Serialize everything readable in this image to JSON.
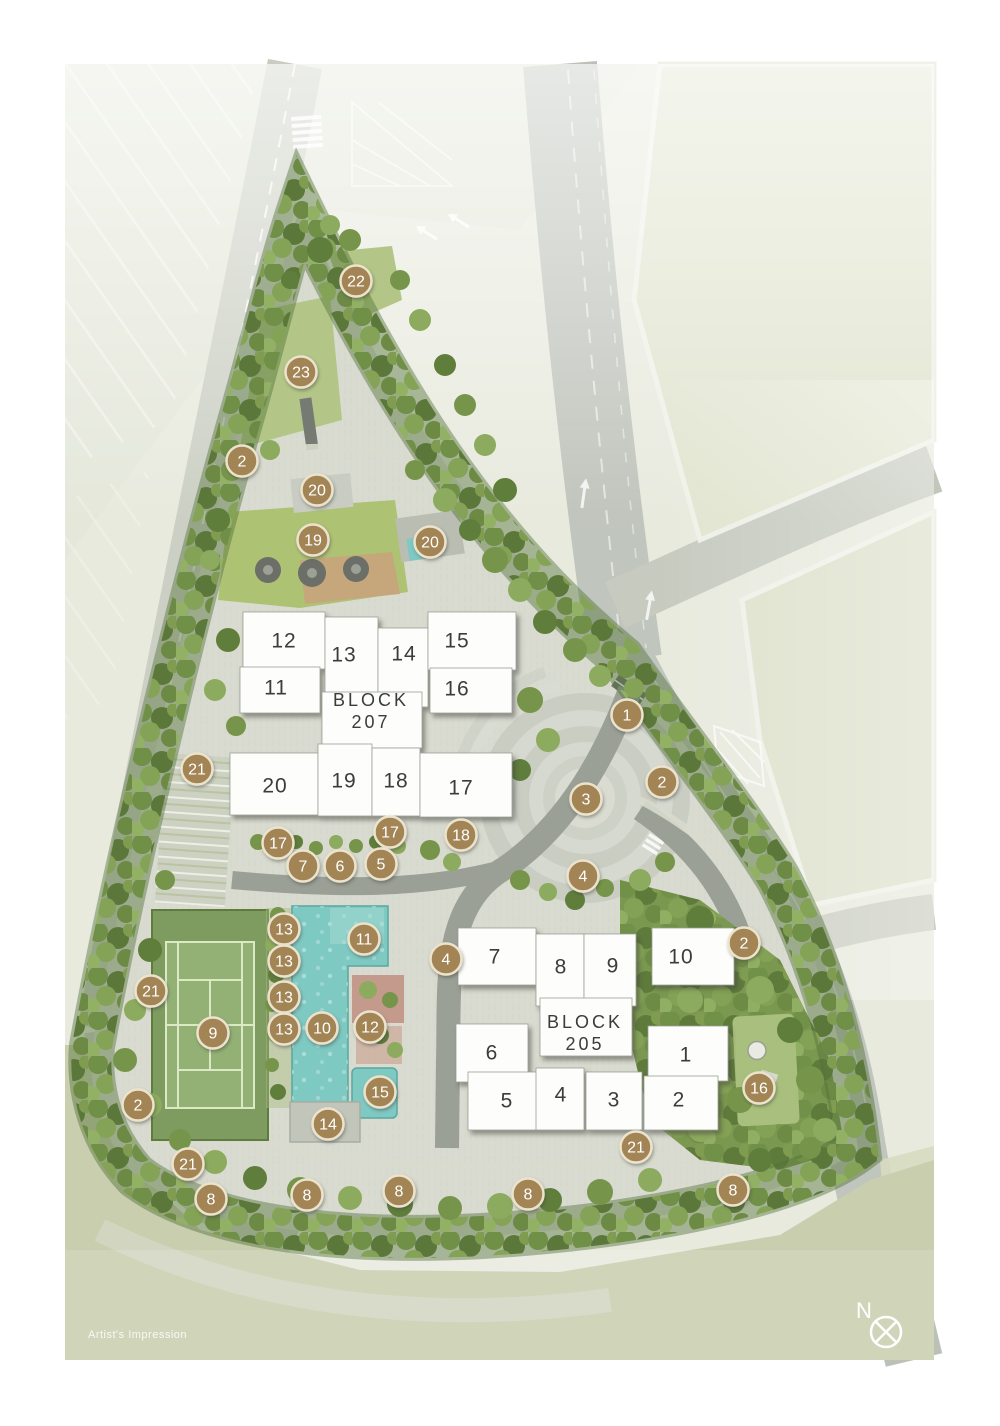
{
  "map": {
    "artists_impression": "Artist's Impression",
    "compass_label": "N"
  },
  "colors": {
    "marker_fill": "#a28455",
    "marker_ring": "#ece3cd",
    "marker_text": "#ffffff",
    "pool_water": "#7fc9c3",
    "tennis_court": "#7d9b5e",
    "building_fill": "#fdfdfb",
    "label_text": "#3a3d38",
    "tree_green": "#76954a",
    "paving": "#d9dbd0",
    "road": "#bcc1b8"
  },
  "blocks": [
    {
      "id": "207",
      "name": "BLOCK",
      "number": "207",
      "label_x": 371,
      "label_y1": 706,
      "label_y2": 728,
      "units": [
        {
          "n": "12",
          "x": 284,
          "y": 641
        },
        {
          "n": "13",
          "x": 344,
          "y": 655
        },
        {
          "n": "14",
          "x": 404,
          "y": 654
        },
        {
          "n": "15",
          "x": 457,
          "y": 641
        },
        {
          "n": "11",
          "x": 276,
          "y": 688
        },
        {
          "n": "16",
          "x": 457,
          "y": 689
        },
        {
          "n": "20",
          "x": 275,
          "y": 786
        },
        {
          "n": "19",
          "x": 344,
          "y": 781
        },
        {
          "n": "18",
          "x": 396,
          "y": 781
        },
        {
          "n": "17",
          "x": 461,
          "y": 788
        }
      ]
    },
    {
      "id": "205",
      "name": "BLOCK",
      "number": "205",
      "label_x": 585,
      "label_y1": 1028,
      "label_y2": 1050,
      "units": [
        {
          "n": "7",
          "x": 495,
          "y": 957
        },
        {
          "n": "8",
          "x": 561,
          "y": 967
        },
        {
          "n": "9",
          "x": 613,
          "y": 966
        },
        {
          "n": "10",
          "x": 681,
          "y": 957
        },
        {
          "n": "6",
          "x": 492,
          "y": 1053
        },
        {
          "n": "1",
          "x": 686,
          "y": 1055
        },
        {
          "n": "5",
          "x": 507,
          "y": 1101
        },
        {
          "n": "4",
          "x": 561,
          "y": 1095
        },
        {
          "n": "3",
          "x": 614,
          "y": 1100
        },
        {
          "n": "2",
          "x": 679,
          "y": 1100
        }
      ]
    }
  ],
  "markers": [
    {
      "n": "22",
      "x": 356,
      "y": 281
    },
    {
      "n": "23",
      "x": 301,
      "y": 372
    },
    {
      "n": "2",
      "x": 242,
      "y": 461
    },
    {
      "n": "20",
      "x": 317,
      "y": 490
    },
    {
      "n": "19",
      "x": 313,
      "y": 540
    },
    {
      "n": "20",
      "x": 430,
      "y": 542
    },
    {
      "n": "1",
      "x": 627,
      "y": 715
    },
    {
      "n": "2",
      "x": 662,
      "y": 782
    },
    {
      "n": "3",
      "x": 586,
      "y": 799
    },
    {
      "n": "21",
      "x": 197,
      "y": 769
    },
    {
      "n": "17",
      "x": 278,
      "y": 843
    },
    {
      "n": "17",
      "x": 390,
      "y": 832
    },
    {
      "n": "18",
      "x": 461,
      "y": 835
    },
    {
      "n": "7",
      "x": 303,
      "y": 866
    },
    {
      "n": "6",
      "x": 340,
      "y": 866
    },
    {
      "n": "5",
      "x": 381,
      "y": 864
    },
    {
      "n": "4",
      "x": 583,
      "y": 876
    },
    {
      "n": "2",
      "x": 744,
      "y": 943
    },
    {
      "n": "4",
      "x": 446,
      "y": 959
    },
    {
      "n": "13",
      "x": 284,
      "y": 929
    },
    {
      "n": "13",
      "x": 284,
      "y": 961
    },
    {
      "n": "13",
      "x": 284,
      "y": 997
    },
    {
      "n": "13",
      "x": 284,
      "y": 1029
    },
    {
      "n": "11",
      "x": 364,
      "y": 939
    },
    {
      "n": "21",
      "x": 151,
      "y": 991
    },
    {
      "n": "9",
      "x": 213,
      "y": 1033
    },
    {
      "n": "10",
      "x": 322,
      "y": 1028
    },
    {
      "n": "12",
      "x": 370,
      "y": 1027
    },
    {
      "n": "15",
      "x": 380,
      "y": 1092
    },
    {
      "n": "14",
      "x": 328,
      "y": 1124
    },
    {
      "n": "2",
      "x": 138,
      "y": 1105
    },
    {
      "n": "21",
      "x": 188,
      "y": 1164
    },
    {
      "n": "16",
      "x": 759,
      "y": 1088
    },
    {
      "n": "21",
      "x": 636,
      "y": 1147
    },
    {
      "n": "8",
      "x": 211,
      "y": 1199
    },
    {
      "n": "8",
      "x": 307,
      "y": 1195
    },
    {
      "n": "8",
      "x": 399,
      "y": 1191
    },
    {
      "n": "8",
      "x": 528,
      "y": 1194
    },
    {
      "n": "8",
      "x": 733,
      "y": 1190
    }
  ]
}
